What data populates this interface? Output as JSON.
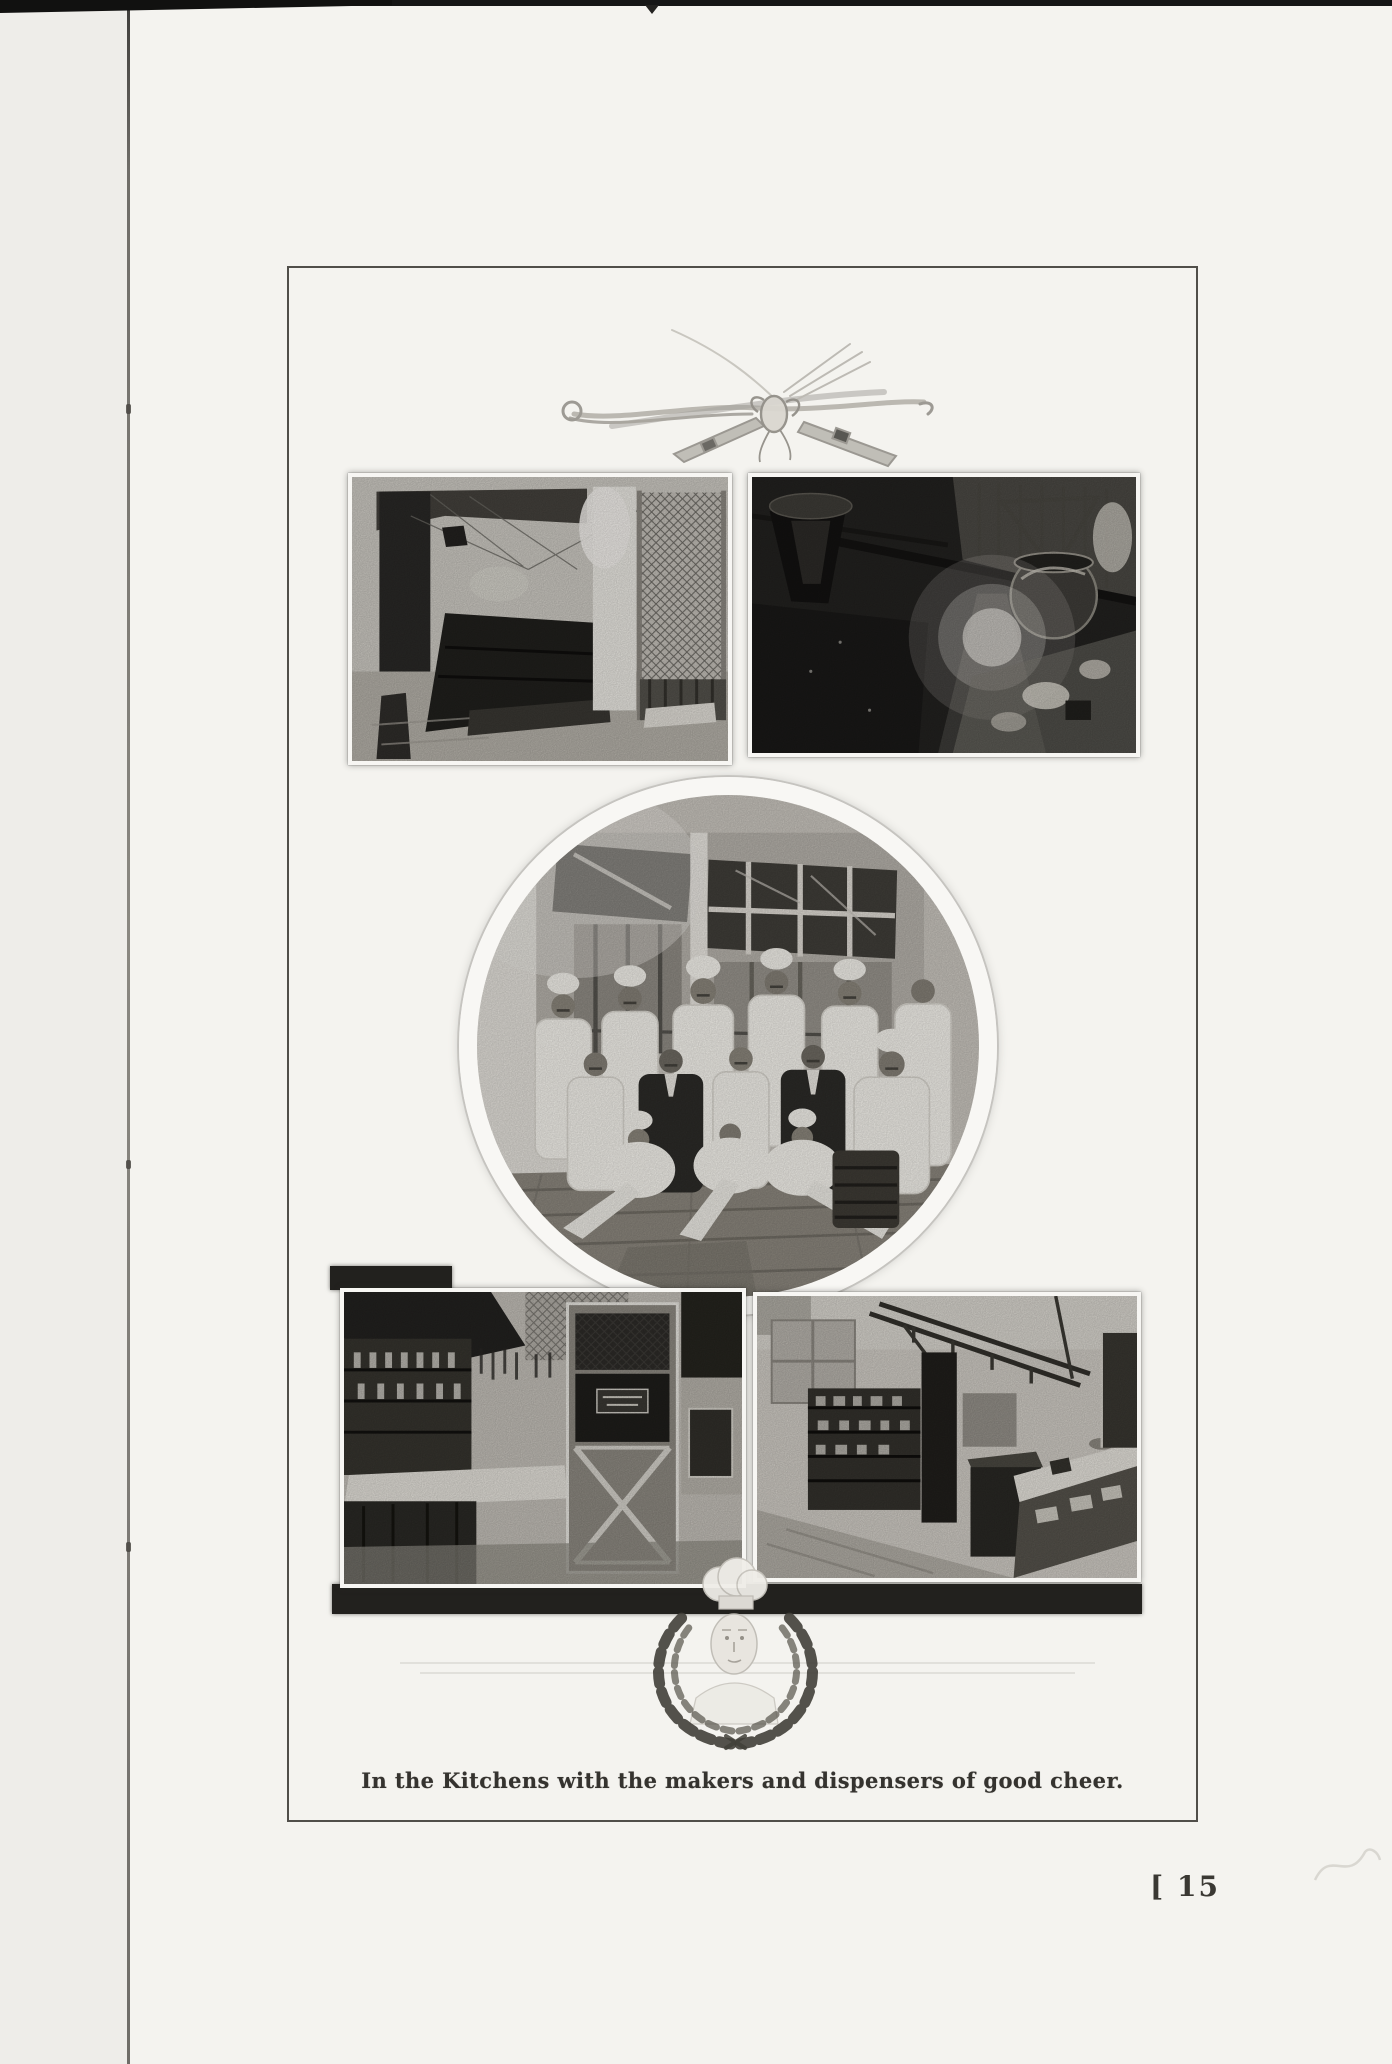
{
  "page": {
    "caption": "In the Kitchens with the makers and dispensers of good cheer.",
    "page_number": "[ 15",
    "figures": {
      "utensils": "Crossed carving fork and knife tied with a ribbon",
      "top_left": "Lunch counter and servery behind wire screen",
      "top_right": "Kitchen range room with steam kettle",
      "circle": "Kitchen staff group portrait before tall windows",
      "bottom_left": "Kitchen corner with shelving and upright broiler",
      "bottom_right": "Kitchen with shelf unit and service counter",
      "emblem": "Chef portrait in laurel wreath"
    },
    "colors": {
      "paper": "#f4f3ef",
      "paper_edge": "#eeede9",
      "frame_line": "#504e49",
      "ink": "#35332f",
      "photo_shadow": "#1d1c1a"
    }
  }
}
